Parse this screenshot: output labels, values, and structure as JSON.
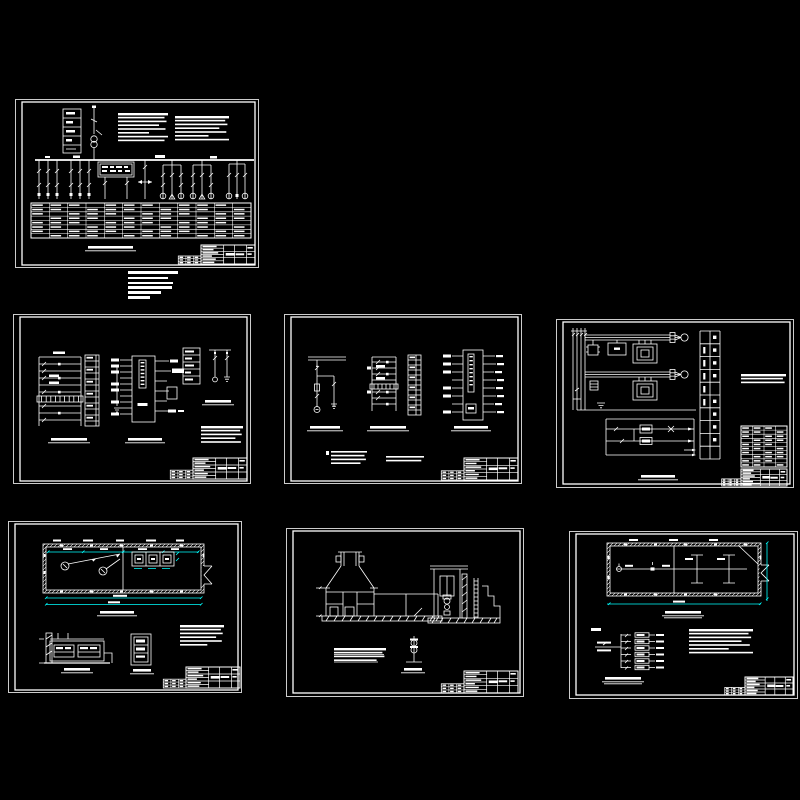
{
  "canvas": {
    "width": 800,
    "height": 800,
    "background": "#000000"
  },
  "palette": {
    "line": "#FFFFFF",
    "dimension": "#00FFFF"
  },
  "sheets": [
    {
      "id": "sheet-1",
      "name": "power-distribution-single-line-sheet",
      "row": "top"
    },
    {
      "id": "sheet-2",
      "name": "secondary-control-circuit-sheet-1",
      "row": "middle"
    },
    {
      "id": "sheet-3",
      "name": "secondary-control-circuit-sheet-2",
      "row": "middle"
    },
    {
      "id": "sheet-4",
      "name": "motor-power-control-sheet",
      "row": "middle"
    },
    {
      "id": "sheet-5",
      "name": "pump-room-plan-elevation-sheet",
      "row": "bottom"
    },
    {
      "id": "sheet-6",
      "name": "structure-sections-sheet",
      "row": "bottom"
    },
    {
      "id": "sheet-7",
      "name": "lighting-plan-distribution-sheet",
      "row": "bottom"
    }
  ],
  "note_block": {
    "lines": 6,
    "line_widths_px": [
      50,
      40,
      45,
      44,
      33,
      22
    ]
  },
  "legibility": "all annotation text in source image is below legible resolution; rendered as glyph bars"
}
